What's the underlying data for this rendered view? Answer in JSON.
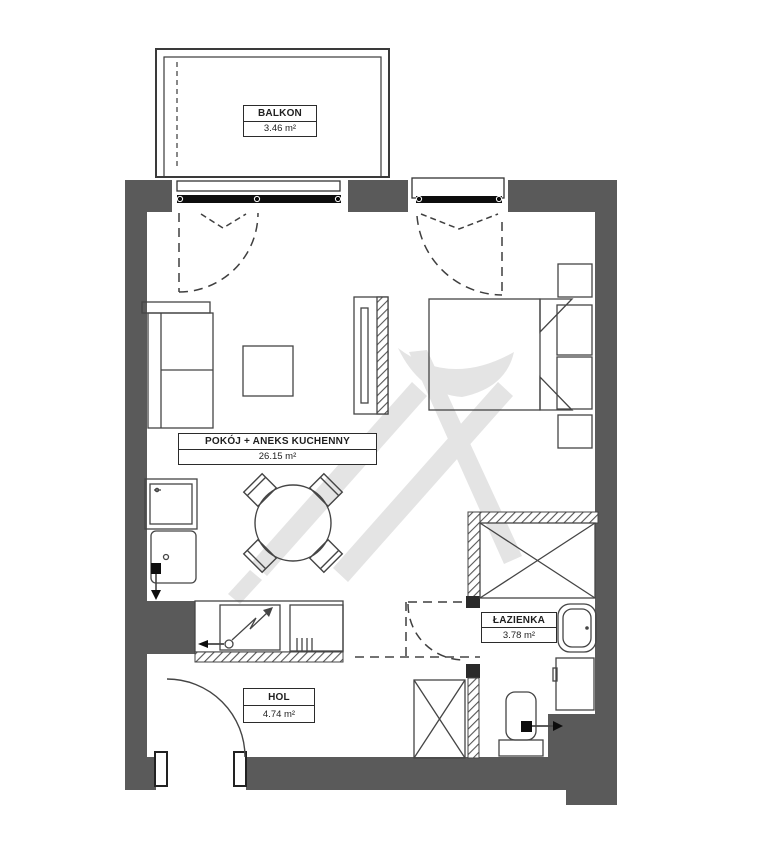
{
  "rooms": {
    "balcony": {
      "name": "BALKON",
      "area": "3.46 m²"
    },
    "living_kitchen": {
      "name": "POKÓJ + ANEKS KUCHENNY",
      "area": "26.15 m²"
    },
    "bathroom": {
      "name": "ŁAZIENKA",
      "area": "3.78 m²"
    },
    "hall": {
      "name": "HOL",
      "area": "4.74 m²"
    }
  },
  "colors": {
    "wall": "#5a5a5a",
    "furniture_line": "#454545",
    "door_black": "#0d0d0d",
    "hatch": "#555555",
    "watermark": "#e4e4e4",
    "background": "#ffffff"
  }
}
